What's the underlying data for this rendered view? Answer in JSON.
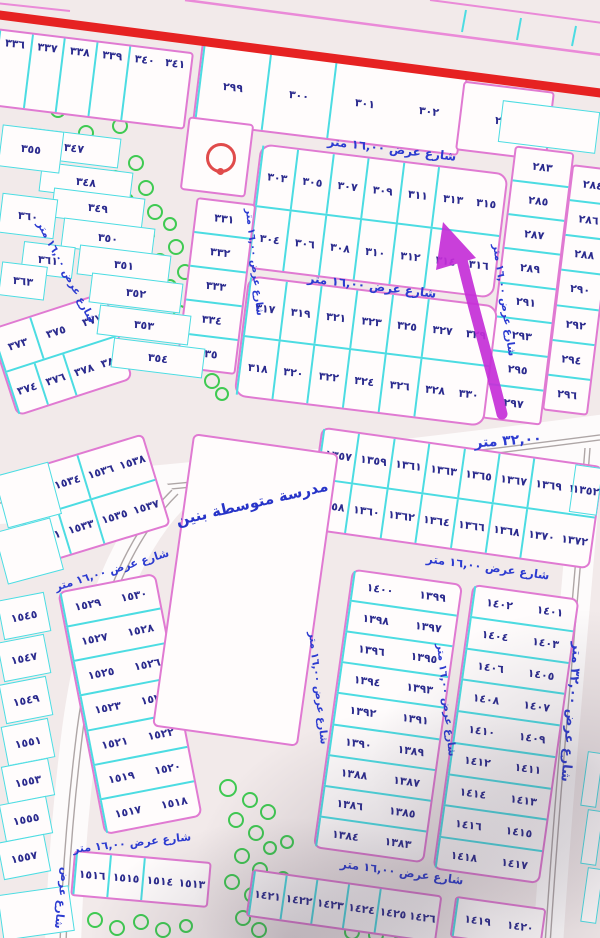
{
  "meta": {
    "type": "cadastral-plot-map",
    "highlighted_plot": "٣٠٦"
  },
  "texts": {
    "street_16": "شارع عرض ١٦,٠٠ متر",
    "street_32": "شارع عرض ٣٢,٠٠ متر",
    "street_only": "شارع عرض",
    "road_width": "٣٢,٠٠ متر",
    "school": "مدرسة متوسطة بنين"
  },
  "annotation": {
    "arrow_points_to": "٣٠٦",
    "arrow_color": "#c52fd8"
  },
  "colors": {
    "plot_border_pink": "#e07ad2",
    "divider_cyan": "#4cdce2",
    "number_navy": "#2b2b8e",
    "street_blue": "#2c3bd0",
    "main_road_red": "#e62222",
    "tree_green": "#3fca52",
    "arrow_magenta": "#c52fd8",
    "mosque_red": "#e04b4b"
  },
  "blocks": [
    {
      "name": "row-336-341",
      "x": -8,
      "y": 40,
      "w": 198,
      "h": 78,
      "rot": 7,
      "r": 4,
      "align": "top",
      "rows": [
        [
          "٣٤١",
          "٣٤٠",
          "٣٣٩",
          "٣٣٨",
          "٣٣٧",
          "٣٣٦"
        ]
      ]
    },
    {
      "name": "row-299-302",
      "x": 196,
      "y": 58,
      "w": 268,
      "h": 82,
      "rot": 7,
      "r": 4,
      "rows": [
        [
          "٣٠٢",
          "٣٠١",
          "٣٠٠",
          "٢٩٩"
        ]
      ]
    },
    {
      "name": "plot-298-block",
      "x": 459,
      "y": 86,
      "w": 92,
      "h": 70,
      "rot": 7,
      "r": 4,
      "rows": [
        [
          "٢٩٨"
        ]
      ]
    },
    {
      "name": "col-283-297",
      "x": 498,
      "y": 148,
      "w": 60,
      "h": 275,
      "rot": 7,
      "r": 4,
      "rows": [
        [
          "٢٨٣"
        ],
        [
          "٢٨٥"
        ],
        [
          "٢٨٧"
        ],
        [
          "٢٨٩"
        ],
        [
          "٢٩١"
        ],
        [
          "٢٩٣"
        ],
        [
          "٢٩٥"
        ],
        [
          "٢٩٧"
        ]
      ]
    },
    {
      "name": "col-284-296",
      "x": 557,
      "y": 166,
      "w": 46,
      "h": 248,
      "rot": 7,
      "r": 4,
      "rows": [
        [
          "٢٨٤"
        ],
        [
          "٢٨٦"
        ],
        [
          "٢٨٨"
        ],
        [
          "٢٩٠"
        ],
        [
          "٢٩٢"
        ],
        [
          "٢٩٤"
        ],
        [
          "٢٩٦"
        ]
      ]
    },
    {
      "name": "block-303-316",
      "x": 252,
      "y": 158,
      "w": 250,
      "h": 126,
      "rot": 7,
      "r": 12,
      "rows": [
        [
          "٣١٥",
          "٣١٣",
          "٣١١",
          "٣٠٩",
          "٣٠٧",
          "٣٠٥",
          "٣٠٣"
        ],
        [
          "٣١٦",
          "٣١٤",
          "٣١٢",
          "٣١٠",
          "٣٠٨",
          "٣٠٦",
          "٣٠٤"
        ]
      ]
    },
    {
      "name": "block-317-330",
      "x": 240,
      "y": 290,
      "w": 252,
      "h": 122,
      "rot": 7,
      "r": 12,
      "rows": [
        [
          "٣٢٩",
          "٣٢٧",
          "٣٢٥",
          "٣٢٣",
          "٣٢١",
          "٣١٩",
          "٣١٧"
        ],
        [
          "٣٣٠",
          "٣٢٨",
          "٣٢٦",
          "٣٢٤",
          "٣٢٢",
          "٣٢٠",
          "٣١٨"
        ]
      ]
    },
    {
      "name": "col-331-335",
      "x": 186,
      "y": 200,
      "w": 60,
      "h": 172,
      "rot": 7,
      "r": 4,
      "rows": [
        [
          "٣٣١"
        ],
        [
          "٣٣٢"
        ],
        [
          "٣٣٣"
        ],
        [
          "٣٣٤"
        ],
        [
          "٣٣٥"
        ]
      ]
    },
    {
      "name": "mosque-plot",
      "x": 184,
      "y": 120,
      "w": 66,
      "h": 74,
      "rot": 7,
      "r": 4,
      "rows": [
        [
          ""
        ]
      ]
    },
    {
      "name": "block-373-380",
      "x": 0,
      "y": 308,
      "w": 122,
      "h": 92,
      "rot": -18,
      "r": 8,
      "rows": [
        [
          "٣٧٧",
          "٣٧٥",
          "٣٧٣"
        ],
        [
          "٣٨٠",
          "٣٧٨",
          "٣٧٦",
          "٣٧٤"
        ]
      ]
    },
    {
      "name": "block-1352-1372",
      "x": 313,
      "y": 446,
      "w": 285,
      "h": 104,
      "rot": 8,
      "r": 8,
      "rows": [
        [
          "١٣٧١",
          "١٣٦٩",
          "١٣٦٧",
          "١٣٦٥",
          "١٣٦٣",
          "١٣٦١",
          "١٣٥٩",
          "١٣٥٧"
        ],
        [
          "١٣٧٢",
          "١٣٧٠",
          "١٣٦٨",
          "١٣٦٦",
          "١٣٦٤",
          "١٣٦٢",
          "١٣٦٠",
          "١٣٥٨"
        ]
      ]
    },
    {
      "name": "block-1383-1400",
      "x": 332,
      "y": 575,
      "w": 112,
      "h": 282,
      "rot": 8,
      "r": 8,
      "rows": [
        [
          "١٣٩٩",
          "١٤٠٠"
        ],
        [
          "١٣٩٧",
          "١٣٩٨"
        ],
        [
          "١٣٩٥",
          "١٣٩٦"
        ],
        [
          "١٣٩٣",
          "١٣٩٤"
        ],
        [
          "١٣٩١",
          "١٣٩٢"
        ],
        [
          "١٣٨٩",
          "١٣٩٠"
        ],
        [
          "١٣٨٧",
          "١٣٨٨"
        ],
        [
          "١٣٨٥",
          "١٣٨٦"
        ],
        [
          "١٣٨٣",
          "١٣٨٤"
        ]
      ]
    },
    {
      "name": "block-1401-1418",
      "x": 452,
      "y": 590,
      "w": 108,
      "h": 288,
      "rot": 8,
      "r": 8,
      "rows": [
        [
          "١٤٠١",
          "١٤٠٢"
        ],
        [
          "١٤٠٣",
          "١٤٠٤"
        ],
        [
          "١٤٠٥",
          "١٤٠٦"
        ],
        [
          "١٤٠٧",
          "١٤٠٨"
        ],
        [
          "١٤٠٩",
          "١٤١٠"
        ],
        [
          "١٤١١",
          "١٤١٢"
        ],
        [
          "١٤١٣",
          "١٤١٤"
        ],
        [
          "١٤١٥",
          "١٤١٦"
        ],
        [
          "١٤١٧",
          "١٤١٨"
        ]
      ]
    },
    {
      "name": "row-1421-1426",
      "x": 248,
      "y": 882,
      "w": 192,
      "h": 48,
      "rot": 8,
      "r": 4,
      "rows": [
        [
          "١٤٢٦",
          "١٤٢٥",
          "١٤٢٤",
          "١٤٢٣",
          "١٤٢٢",
          "١٤٢١"
        ]
      ]
    },
    {
      "name": "row-1419-1420",
      "x": 452,
      "y": 902,
      "w": 92,
      "h": 42,
      "rot": 8,
      "r": 4,
      "rows": [
        [
          "١٤٢٠",
          "١٤١٩"
        ]
      ]
    },
    {
      "name": "block-1531-1538",
      "x": 18,
      "y": 452,
      "w": 142,
      "h": 96,
      "rot": -17,
      "r": 6,
      "rows": [
        [
          "١٥٣٨",
          "١٥٣٦",
          "١٥٣٤",
          "١٥٣٢"
        ],
        [
          "١٥٣٧",
          "١٥٣٥",
          "١٥٣٣",
          "١٥٣١"
        ]
      ]
    },
    {
      "name": "block-1517-1530",
      "x": 80,
      "y": 580,
      "w": 100,
      "h": 248,
      "rot": -11,
      "r": 8,
      "rows": [
        [
          "١٥٣٠",
          "١٥٢٩"
        ],
        [
          "١٥٢٨",
          "١٥٢٧"
        ],
        [
          "١٥٢٦",
          "١٥٢٥"
        ],
        [
          "١٥٢٤",
          "١٥٢٣"
        ],
        [
          "١٥٢٢",
          "١٥٢١"
        ],
        [
          "١٥٢٠",
          "١٥١٩"
        ],
        [
          "١٥١٨",
          "١٥١٧"
        ]
      ]
    },
    {
      "name": "row-1513-1516",
      "x": 72,
      "y": 856,
      "w": 138,
      "h": 46,
      "rot": 5,
      "r": 4,
      "rows": [
        [
          "١٥١٣",
          "١٥١٤",
          "١٥١٥",
          "١٥١٦"
        ]
      ]
    },
    {
      "name": "school-plot",
      "x": 172,
      "y": 442,
      "w": 147,
      "h": 296,
      "rot": 8,
      "r": 6,
      "rows": [
        [
          ""
        ]
      ]
    }
  ],
  "free_cells": [
    {
      "label": "٣٤٧",
      "x": 28,
      "y": 133,
      "w": 92,
      "h": 30,
      "rot": 7
    },
    {
      "label": "٣٤٨",
      "x": 40,
      "y": 167,
      "w": 92,
      "h": 30,
      "rot": 7
    },
    {
      "label": "٣٤٩",
      "x": 52,
      "y": 193,
      "w": 92,
      "h": 30,
      "rot": 7
    },
    {
      "label": "٣٥٠",
      "x": 62,
      "y": 223,
      "w": 92,
      "h": 30,
      "rot": 7
    },
    {
      "label": "٣٥١",
      "x": 78,
      "y": 250,
      "w": 92,
      "h": 30,
      "rot": 7
    },
    {
      "label": "٣٥٢",
      "x": 90,
      "y": 278,
      "w": 92,
      "h": 30,
      "rot": 7
    },
    {
      "label": "٣٥٣",
      "x": 98,
      "y": 310,
      "w": 92,
      "h": 30,
      "rot": 7
    },
    {
      "label": "٣٥٤",
      "x": 112,
      "y": 343,
      "w": 92,
      "h": 30,
      "rot": 7
    },
    {
      "label": "٣٥٥",
      "x": 0,
      "y": 128,
      "w": 62,
      "h": 42,
      "rot": 7
    },
    {
      "label": "٣٦٠",
      "x": 0,
      "y": 196,
      "w": 56,
      "h": 40,
      "rot": 7
    },
    {
      "label": "٣٦١",
      "x": 22,
      "y": 244,
      "w": 52,
      "h": 32,
      "rot": 7
    },
    {
      "label": "٣٦٣",
      "x": 0,
      "y": 264,
      "w": 46,
      "h": 34,
      "rot": 7
    },
    {
      "label": "١٣٥٢",
      "x": 572,
      "y": 466,
      "w": 28,
      "h": 48,
      "rot": 8
    },
    {
      "label": "١٥٤٥",
      "x": 0,
      "y": 596,
      "w": 48,
      "h": 40,
      "rot": -11
    },
    {
      "label": "١٥٤٧",
      "x": 0,
      "y": 638,
      "w": 48,
      "h": 40,
      "rot": -11
    },
    {
      "label": "١٥٤٩",
      "x": 2,
      "y": 680,
      "w": 48,
      "h": 40,
      "rot": -11
    },
    {
      "label": "١٥٥١",
      "x": 4,
      "y": 722,
      "w": 48,
      "h": 40,
      "rot": -11
    },
    {
      "label": "١٥٥٣",
      "x": 4,
      "y": 762,
      "w": 48,
      "h": 38,
      "rot": -11
    },
    {
      "label": "١٥٥٥",
      "x": 2,
      "y": 800,
      "w": 48,
      "h": 38,
      "rot": -11
    },
    {
      "label": "١٥٥٧",
      "x": 0,
      "y": 838,
      "w": 48,
      "h": 38,
      "rot": -11
    },
    {
      "label": "",
      "x": 500,
      "y": 106,
      "w": 98,
      "h": 42,
      "rot": 7
    },
    {
      "label": "",
      "x": 0,
      "y": 468,
      "w": 56,
      "h": 54,
      "rot": -15
    },
    {
      "label": "",
      "x": 0,
      "y": 524,
      "w": 58,
      "h": 54,
      "rot": -15
    },
    {
      "label": "",
      "x": 584,
      "y": 752,
      "w": 16,
      "h": 55,
      "rot": 8
    },
    {
      "label": "",
      "x": 584,
      "y": 810,
      "w": 16,
      "h": 55,
      "rot": 8
    },
    {
      "label": "",
      "x": 584,
      "y": 868,
      "w": 16,
      "h": 55,
      "rot": 8
    },
    {
      "label": "",
      "x": 0,
      "y": 890,
      "w": 72,
      "h": 46,
      "rot": -8
    }
  ],
  "street_labels": [
    {
      "key": "street_16",
      "x": 392,
      "y": 149,
      "rot": 7,
      "fs": 12
    },
    {
      "key": "street_16",
      "x": 372,
      "y": 286,
      "rot": 7,
      "fs": 12
    },
    {
      "key": "street_16",
      "x": 504,
      "y": 300,
      "rot": 82,
      "fs": 10.5
    },
    {
      "key": "street_16",
      "x": 254,
      "y": 262,
      "rot": 84,
      "fs": 10
    },
    {
      "key": "street_16",
      "x": 66,
      "y": 272,
      "rot": 62,
      "fs": 10.5
    },
    {
      "key": "street_16",
      "x": 488,
      "y": 567,
      "rot": 8,
      "fs": 11.5
    },
    {
      "key": "street_16",
      "x": 318,
      "y": 688,
      "rot": 84,
      "fs": 10.5
    },
    {
      "key": "street_16",
      "x": 446,
      "y": 700,
      "rot": 84,
      "fs": 10.5
    },
    {
      "key": "street_16",
      "x": 402,
      "y": 872,
      "rot": 8,
      "fs": 11.5
    },
    {
      "key": "street_32",
      "x": 571,
      "y": 712,
      "rot": 95,
      "fs": 13
    },
    {
      "key": "street_16",
      "x": 112,
      "y": 570,
      "rot": -17,
      "fs": 11
    },
    {
      "key": "street_16",
      "x": 132,
      "y": 843,
      "rot": -6,
      "fs": 11
    },
    {
      "key": "street_only",
      "x": 62,
      "y": 898,
      "rot": 97,
      "fs": 11
    }
  ]
}
